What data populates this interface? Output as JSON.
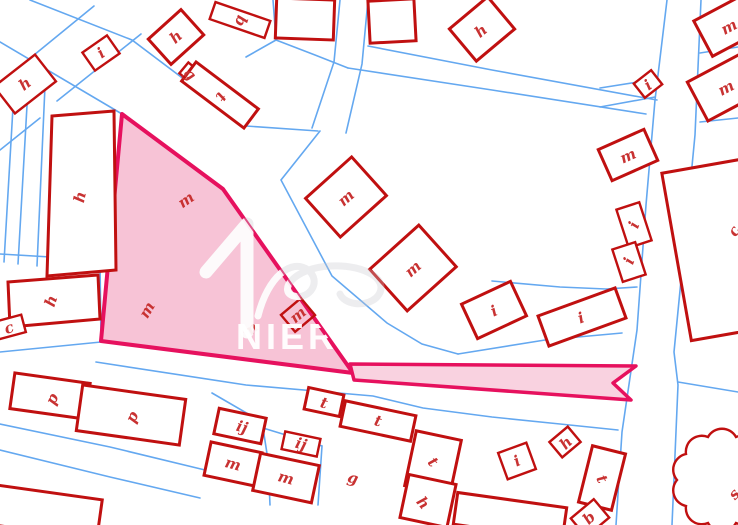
{
  "map": {
    "type": "cadastral-parcel-map",
    "colors": {
      "parcel_line": "#64a8f0",
      "building_stroke": "#c01010",
      "label_color": "#c83232",
      "highlight_fill": "#f7c3d6",
      "highlight_strip_fill": "#f9d2e0",
      "highlight_stroke": "#e6115e",
      "watermark": "#ffffff"
    },
    "highlight": {
      "name": "selected-parcel"
    },
    "watermark": {
      "text": "NIERU",
      "logo": "house-numeral-with-flourish"
    },
    "labels": [
      {
        "letter": "h"
      },
      {
        "letter": "i"
      },
      {
        "letter": "h"
      },
      {
        "letter": "b"
      },
      {
        "letter": "g"
      },
      {
        "letter": "t"
      },
      {
        "letter": "h"
      },
      {
        "letter": "i"
      },
      {
        "letter": "m"
      },
      {
        "letter": "m"
      },
      {
        "letter": "m"
      },
      {
        "letter": "m"
      },
      {
        "letter": "m"
      },
      {
        "letter": "i"
      },
      {
        "letter": "i"
      },
      {
        "letter": "i"
      },
      {
        "letter": "i"
      },
      {
        "letter": "c"
      },
      {
        "letter": "h"
      },
      {
        "letter": "h"
      },
      {
        "letter": "c"
      },
      {
        "letter": "m"
      },
      {
        "letter": "m"
      },
      {
        "letter": "m"
      },
      {
        "letter": "m"
      },
      {
        "letter": "p"
      },
      {
        "letter": "p"
      },
      {
        "letter": "ij"
      },
      {
        "letter": "ij"
      },
      {
        "letter": "m"
      },
      {
        "letter": "m"
      },
      {
        "letter": "g"
      },
      {
        "letter": "t"
      },
      {
        "letter": "t"
      },
      {
        "letter": "t"
      },
      {
        "letter": "h"
      },
      {
        "letter": "i"
      },
      {
        "letter": "h"
      },
      {
        "letter": "t"
      },
      {
        "letter": "b"
      },
      {
        "letter": "s"
      }
    ]
  }
}
